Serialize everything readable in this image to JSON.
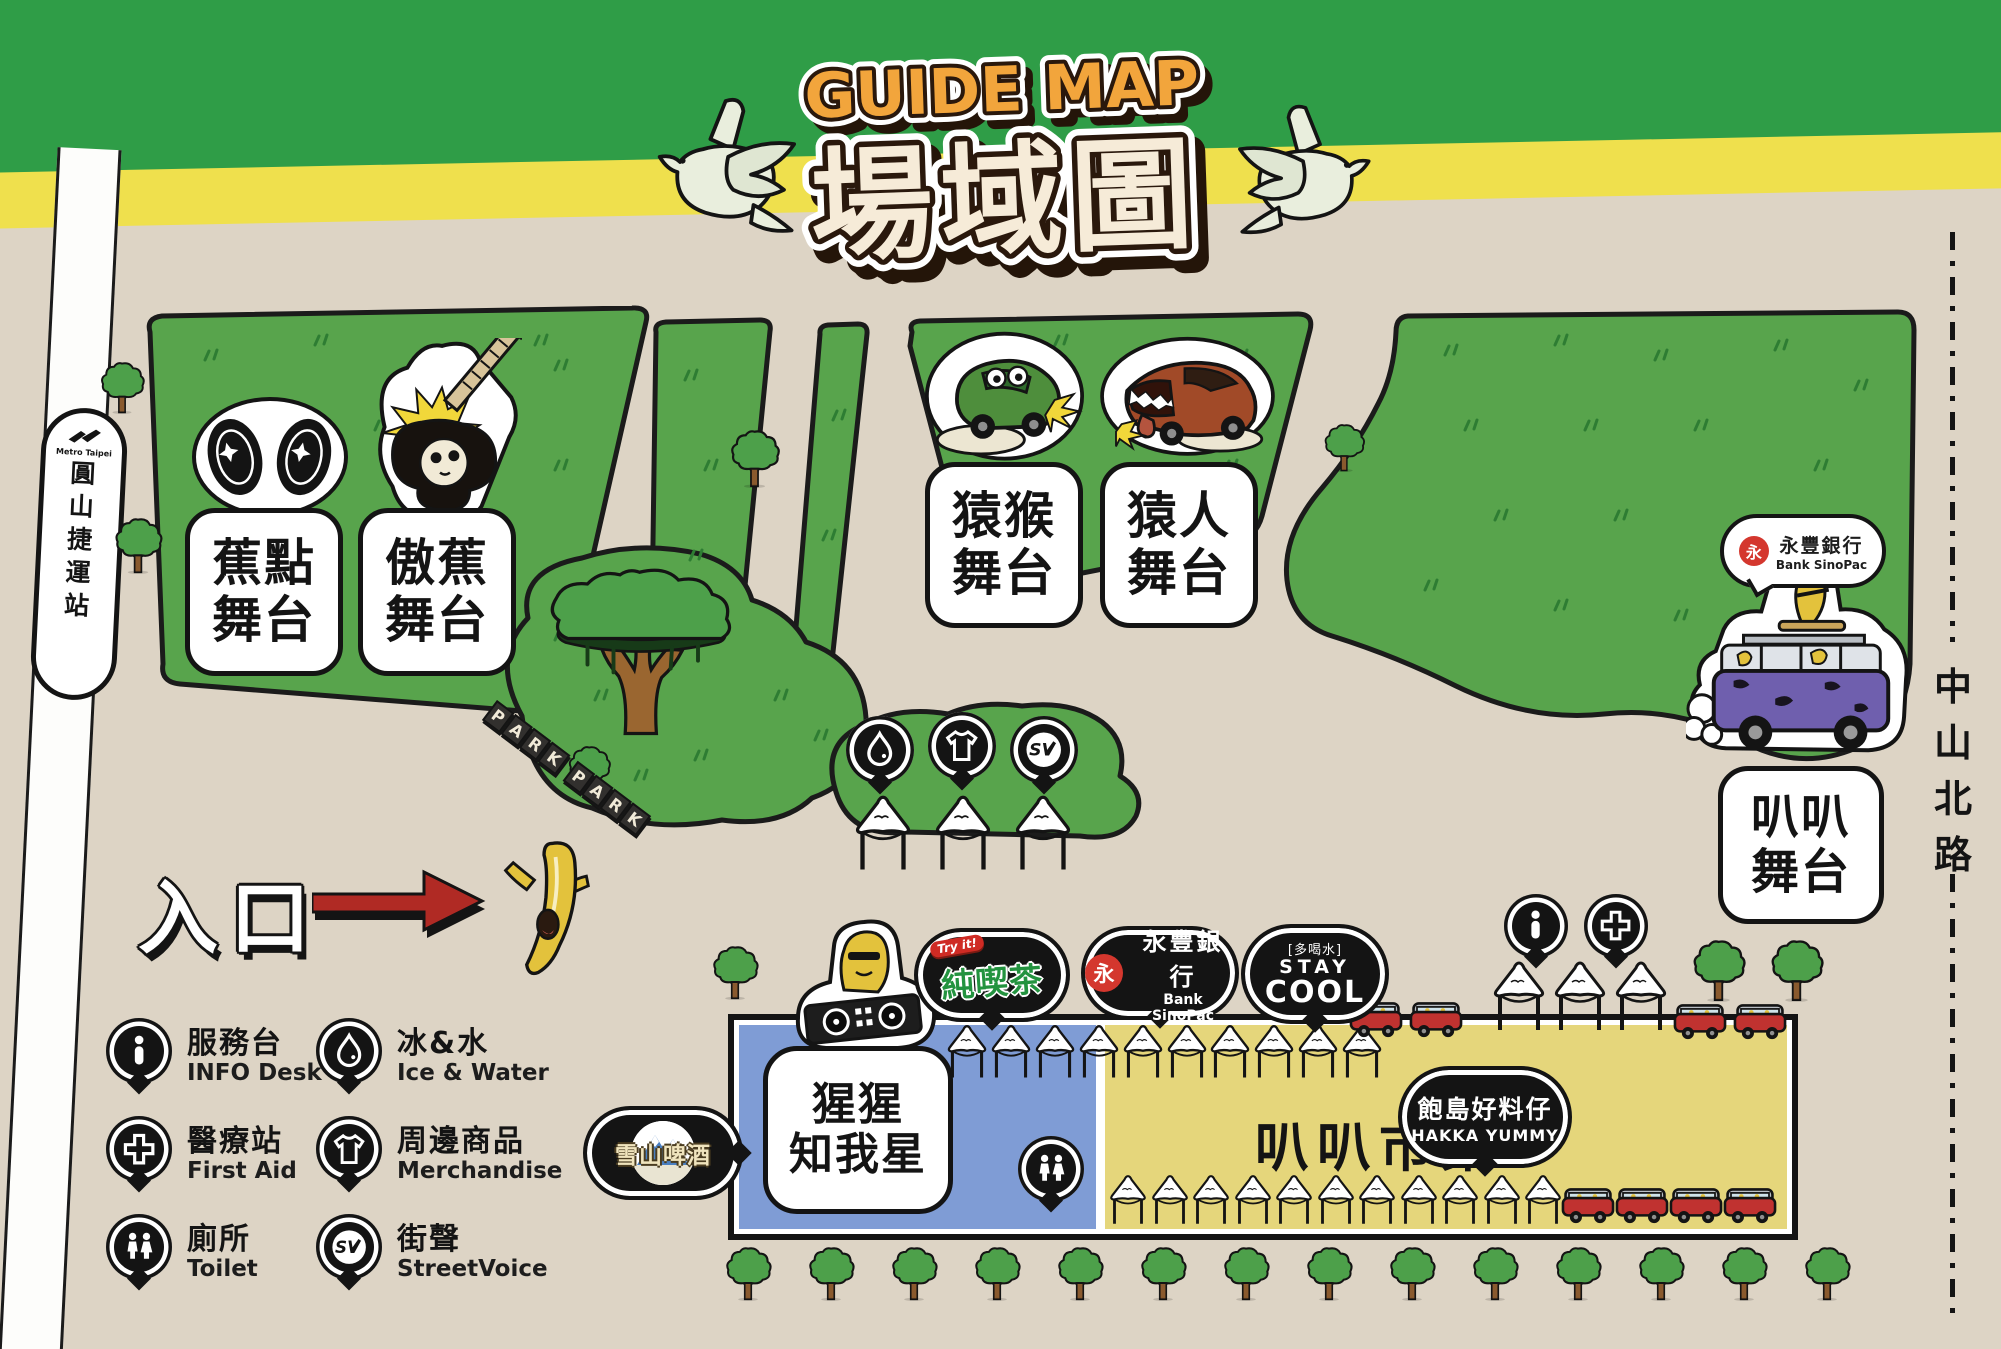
{
  "header": {
    "title_en": "GUIDE MAP",
    "title_zh": "場域圖"
  },
  "station": {
    "brand": "Metro Taipei",
    "name_chars": [
      "圓",
      "山",
      "捷",
      "運",
      "站"
    ]
  },
  "street": {
    "chars": [
      "中",
      "山",
      "北",
      "路"
    ]
  },
  "entrance_label": "入口",
  "park_sign": "PARK PARK",
  "stages": {
    "jiaodian": {
      "line1": "蕉點",
      "line2": "舞台"
    },
    "aojiao": {
      "line1": "傲蕉",
      "line2": "舞台"
    },
    "yuanhou": {
      "line1": "猿猴",
      "line2": "舞台"
    },
    "yuanren": {
      "line1": "猿人",
      "line2": "舞台"
    },
    "baba": {
      "line1": "叭叭",
      "line2": "舞台"
    },
    "xingxing": {
      "line1": "猩猩",
      "line2": "知我星"
    }
  },
  "market": {
    "name": "叭叭市集"
  },
  "badges": {
    "chun": {
      "ribbon": "Try it!",
      "name": "純喫茶"
    },
    "sinopac": {
      "zh": "永豐銀行",
      "en": "Bank SinoPac",
      "mark": "永"
    },
    "staycool": {
      "tag": "[多喝水]",
      "line1": "STAY",
      "line2": "COOL"
    },
    "snow": {
      "name": "雪山啤酒"
    },
    "hakka": {
      "zh": "飽島好料仔",
      "en": "HAKKA YUMMY"
    }
  },
  "legend": {
    "info": {
      "zh": "服務台",
      "en": "INFO Desk"
    },
    "water": {
      "zh": "冰&水",
      "en": "Ice & Water"
    },
    "aid": {
      "zh": "醫療站",
      "en": "First Aid"
    },
    "merch": {
      "zh": "周邊商品",
      "en": "Merchandise"
    },
    "toilet": {
      "zh": "廁所",
      "en": "Toilet"
    },
    "sv": {
      "zh": "街聲",
      "en": "StreetVoice"
    }
  },
  "icons": [
    "info-icon",
    "water-drop-icon",
    "first-aid-cross-icon",
    "tshirt-icon",
    "toilet-icon",
    "streetvoice-sv-icon"
  ],
  "colors": {
    "banner_green": "#2f9d47",
    "banner_yellow": "#efe04d",
    "ground_beige": "#ddd4c5",
    "field_green": "#58a44c",
    "outline_black": "#141414",
    "title_orange": "#F2A53C",
    "title_cream": "#F6EBD8",
    "market_blue": "#7f9cd5",
    "market_yellow": "#e5d67b",
    "arrow_red": "#b02a24",
    "truck_red": "#c03230",
    "banana_yellow": "#e3c23c",
    "van_purple": "#6f5fae"
  },
  "decor": {
    "trees": [
      [
        98,
        362,
        52
      ],
      [
        112,
        518,
        56
      ],
      [
        728,
        430,
        58
      ],
      [
        1322,
        424,
        48
      ],
      [
        566,
        746,
        50
      ],
      [
        710,
        946,
        54
      ],
      [
        1690,
        940,
        62
      ],
      [
        1768,
        940,
        62
      ],
      [
        723,
        1247,
        54
      ],
      [
        806,
        1247,
        54
      ],
      [
        889,
        1247,
        54
      ],
      [
        972,
        1247,
        54
      ],
      [
        1055,
        1247,
        54
      ],
      [
        1138,
        1247,
        54
      ],
      [
        1221,
        1247,
        54
      ],
      [
        1304,
        1247,
        54
      ],
      [
        1387,
        1247,
        54
      ],
      [
        1470,
        1247,
        54
      ],
      [
        1553,
        1247,
        54
      ],
      [
        1636,
        1247,
        54
      ],
      [
        1719,
        1247,
        54
      ],
      [
        1802,
        1247,
        54
      ]
    ],
    "tents": [
      [
        944,
        1016,
        46,
        74
      ],
      [
        988,
        1016,
        46,
        74
      ],
      [
        1032,
        1016,
        46,
        74
      ],
      [
        1076,
        1016,
        46,
        74
      ],
      [
        1120,
        1016,
        46,
        74
      ],
      [
        1164,
        1016,
        46,
        74
      ],
      [
        1207,
        1016,
        46,
        74
      ],
      [
        1251,
        1016,
        46,
        74
      ],
      [
        1295,
        1016,
        46,
        74
      ],
      [
        1339,
        1016,
        46,
        74
      ],
      [
        1106,
        1174,
        44,
        54
      ],
      [
        1148,
        1174,
        44,
        54
      ],
      [
        1189,
        1174,
        44,
        54
      ],
      [
        1231,
        1174,
        44,
        54
      ],
      [
        1272,
        1174,
        44,
        54
      ],
      [
        1314,
        1174,
        44,
        54
      ],
      [
        1355,
        1174,
        44,
        54
      ],
      [
        1397,
        1174,
        44,
        54
      ],
      [
        1438,
        1174,
        44,
        54
      ],
      [
        1480,
        1174,
        44,
        54
      ],
      [
        1521,
        1174,
        44,
        54
      ],
      [
        1488,
        960,
        62,
        76
      ],
      [
        1549,
        960,
        62,
        76
      ],
      [
        1610,
        960,
        62,
        76
      ],
      [
        848,
        794,
        70,
        82
      ],
      [
        928,
        794,
        70,
        82
      ],
      [
        1008,
        794,
        70,
        82
      ]
    ],
    "trucks": [
      [
        1348,
        1000
      ],
      [
        1408,
        1000
      ],
      [
        1672,
        1002
      ],
      [
        1732,
        1002
      ],
      [
        1560,
        1186
      ],
      [
        1614,
        1186
      ],
      [
        1668,
        1186
      ],
      [
        1722,
        1186
      ]
    ],
    "grass_tufts": [
      [
        210,
        360
      ],
      [
        320,
        345
      ],
      [
        430,
        372
      ],
      [
        540,
        345
      ],
      [
        250,
        420
      ],
      [
        380,
        430
      ],
      [
        480,
        410
      ],
      [
        560,
        370
      ],
      [
        300,
        500
      ],
      [
        430,
        500
      ],
      [
        560,
        470
      ],
      [
        220,
        480
      ],
      [
        690,
        380
      ],
      [
        710,
        470
      ],
      [
        695,
        560
      ],
      [
        838,
        420
      ],
      [
        828,
        540
      ],
      [
        960,
        355
      ],
      [
        1060,
        345
      ],
      [
        1160,
        360
      ],
      [
        1240,
        360
      ],
      [
        1000,
        430
      ],
      [
        1150,
        430
      ],
      [
        1230,
        470
      ],
      [
        1050,
        520
      ],
      [
        1450,
        355
      ],
      [
        1560,
        345
      ],
      [
        1660,
        360
      ],
      [
        1780,
        350
      ],
      [
        1860,
        390
      ],
      [
        1470,
        430
      ],
      [
        1590,
        430
      ],
      [
        1700,
        430
      ],
      [
        1820,
        470
      ],
      [
        1500,
        520
      ],
      [
        1620,
        520
      ],
      [
        1740,
        540
      ],
      [
        1850,
        560
      ],
      [
        1430,
        590
      ],
      [
        1560,
        610
      ],
      [
        1680,
        620
      ],
      [
        560,
        640
      ],
      [
        600,
        700
      ],
      [
        700,
        760
      ],
      [
        780,
        700
      ],
      [
        640,
        780
      ],
      [
        820,
        740
      ],
      [
        880,
        780
      ],
      [
        1050,
        780
      ]
    ]
  }
}
